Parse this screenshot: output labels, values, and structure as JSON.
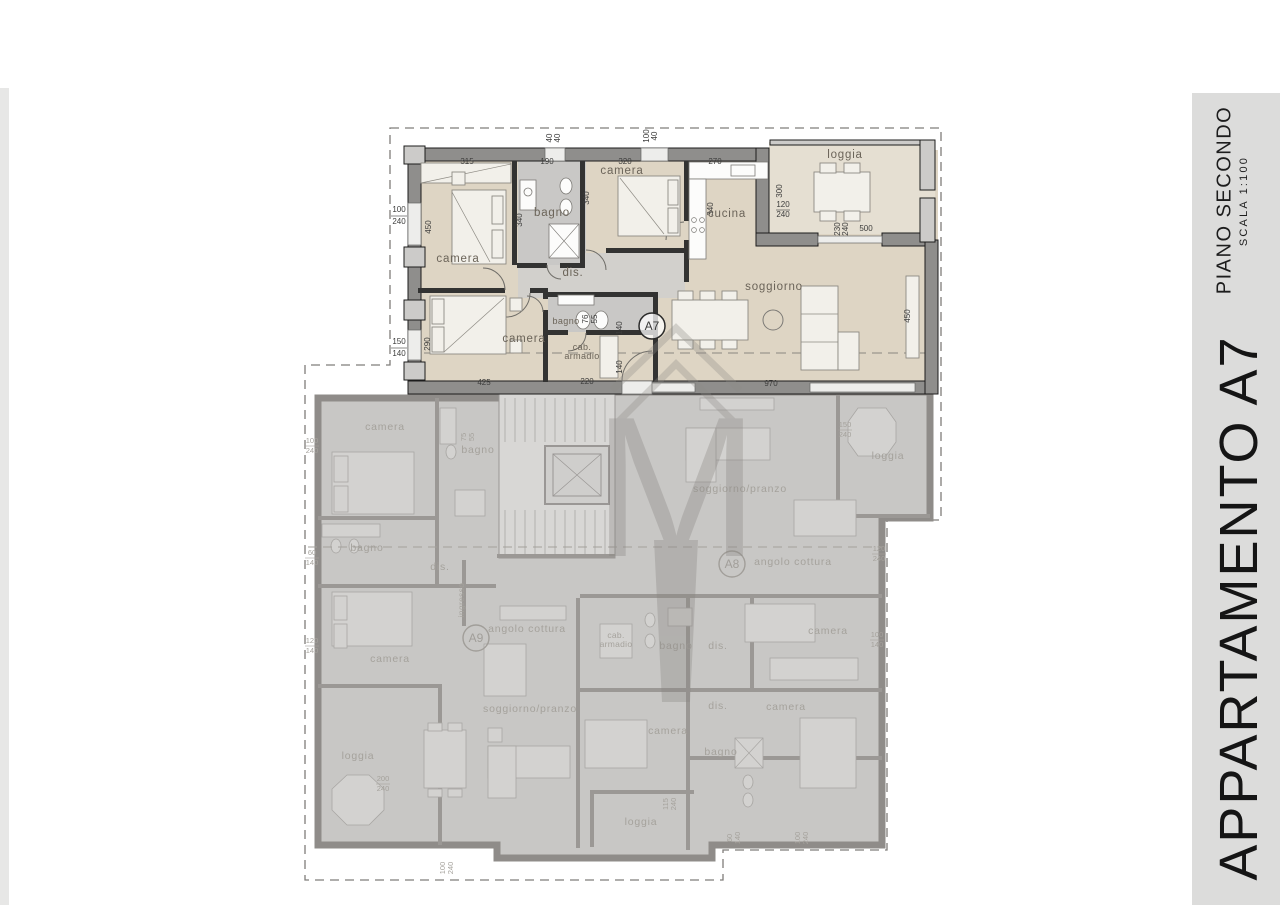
{
  "sidebar": {
    "floor_title": "PIANO SECONDO",
    "scale_label": "SCALA 1:100",
    "apartment_title": "APPARTAMENTO A7"
  },
  "a7": {
    "badge": "A7",
    "rooms": {
      "camera1": "camera",
      "bagno1": "bagno",
      "camera3": "camera",
      "cucina": "cucina",
      "loggia": "loggia",
      "dis": "dis.",
      "camera2": "camera",
      "bagno2": "bagno",
      "cab1": "cab.",
      "cab2": "armadio",
      "soggiorno": "soggiorno"
    },
    "dims": {
      "camera1_w": "315",
      "bagno1_w": "190",
      "camera3_w": "320",
      "cucina_w": "270",
      "vent_w": "40",
      "vent_h": "40",
      "win_top_w": "100",
      "win_top_h": "40",
      "win_l1_w": "100",
      "win_l1_h": "240",
      "camera1_d": "450",
      "bagno1_d": "340",
      "camera3_d": "340",
      "cucina_d": "340",
      "loggia_d": "300",
      "win_log_w": "120",
      "win_log_h": "240",
      "win_sog_w": "230",
      "win_sog_h": "240",
      "win_sog_len": "500",
      "win_l2_w": "150",
      "win_l2_h": "140",
      "camera2_d": "290",
      "camera2_w": "425",
      "cab_w": "220",
      "bagno2_d": "140",
      "cab_d": "140",
      "wc_w": "76",
      "wc_d": "55",
      "sogg_w": "970",
      "sogg_d": "450"
    }
  },
  "a8": {
    "badge": "A8",
    "rooms": {
      "soggiorno": "soggiorno/pranzo",
      "angolo": "angolo cottura",
      "loggia": "loggia",
      "cab1": "cab.",
      "cab2": "armadio",
      "bagno_top": "bagno",
      "dis_top": "dis.",
      "camera_ne": "camera",
      "dis_mid": "dis.",
      "camera_e": "camera",
      "camera_w": "camera",
      "bagno_s": "bagno",
      "loggia_s": "loggia"
    },
    "dims": {
      "loggia_w": "150",
      "loggia_h": "240",
      "east1_w": "120",
      "east1_h": "240",
      "east2_w": "100",
      "east2_h": "140",
      "south1_w": "115",
      "south1_h": "240",
      "south2_w": "60",
      "south2_h": "140",
      "south3_w": "100",
      "south3_h": "240"
    }
  },
  "a9": {
    "badge": "A9",
    "rooms": {
      "camera_top": "camera",
      "bagno_top": "bagno",
      "bagno_mid": "bagno",
      "dis": "dis.",
      "camera_mid": "camera",
      "ingresso": "ingresso",
      "angolo": "angolo cottura",
      "soggiorno": "soggiorno/pranzo",
      "loggia": "loggia"
    },
    "dims": {
      "win1_w": "100",
      "win1_h": "240",
      "win2_w": "60",
      "win2_h": "140",
      "win3_w": "120",
      "win3_h": "140",
      "loggia_w": "200",
      "loggia_h": "240",
      "bottom_w": "100",
      "bottom_h": "240",
      "bagno_w": "75",
      "bagno_h": "55"
    }
  }
}
